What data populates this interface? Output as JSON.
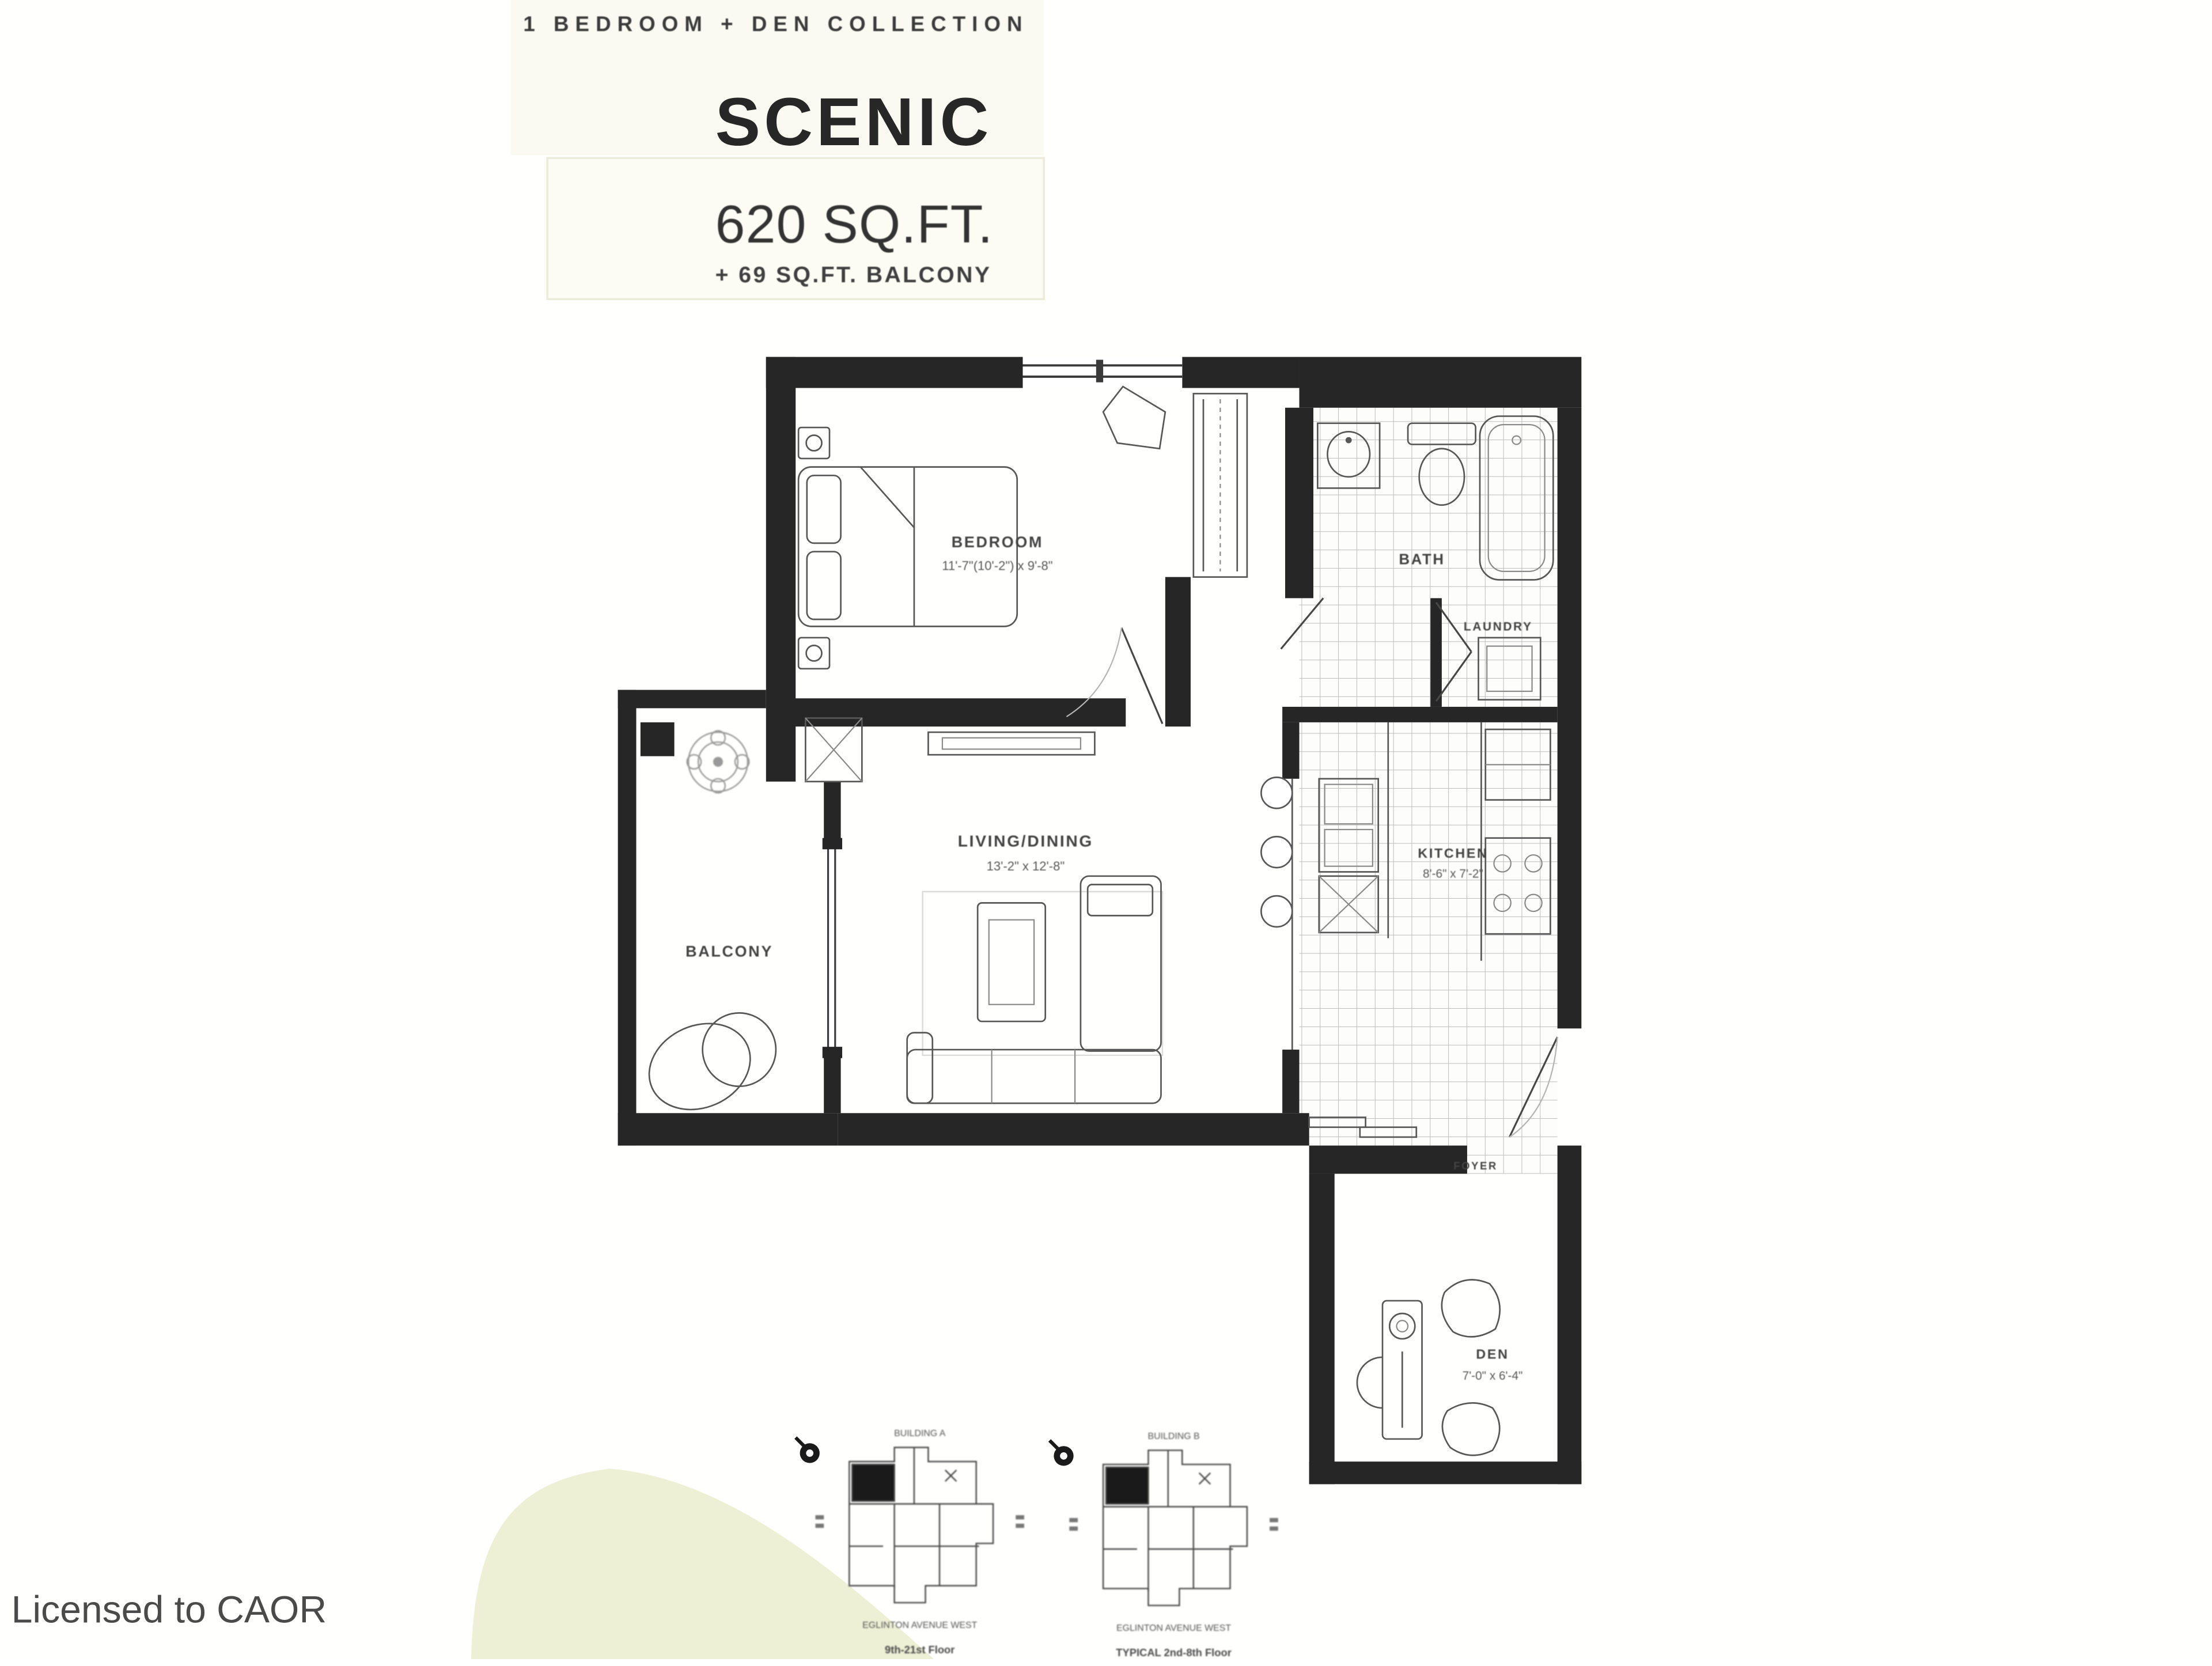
{
  "header": {
    "collection": "1 BEDROOM + DEN COLLECTION",
    "plan_name": "SCENIC",
    "area": "620 SQ.FT.",
    "balcony_area": "+ 69 SQ.FT. BALCONY"
  },
  "rooms": {
    "bedroom": {
      "label": "BEDROOM",
      "dims": "11'-7\"(10'-2\") x 9'-8\""
    },
    "living": {
      "label": "LIVING/DINING",
      "dims": "13'-2\" x 12'-8\""
    },
    "kitchen": {
      "label": "KITCHEN",
      "dims": "8'-6\" x 7'-2\""
    },
    "den": {
      "label": "DEN",
      "dims": "7'-0\" x 6'-4\""
    },
    "bath": {
      "label": "BATH"
    },
    "laundry": {
      "label": "LAUNDRY"
    },
    "balcony": {
      "label": "BALCONY"
    },
    "foyer": {
      "label": "FOYER"
    }
  },
  "keyplans": [
    {
      "top_label": "BUILDING A",
      "street": "EGLINTON AVENUE WEST",
      "floors": "9th-21st Floor"
    },
    {
      "top_label": "BUILDING B",
      "street": "EGLINTON AVENUE WEST",
      "floors": "TYPICAL 2nd-8th Floor"
    }
  ],
  "page": {
    "license": "Licensed to CAOR"
  },
  "colors": {
    "wall": "#262626",
    "tile-line": "#bcbcbc",
    "text": "#3c3c3c",
    "watermark-green": "#eef0d6",
    "cream": "#f6f6ea"
  }
}
